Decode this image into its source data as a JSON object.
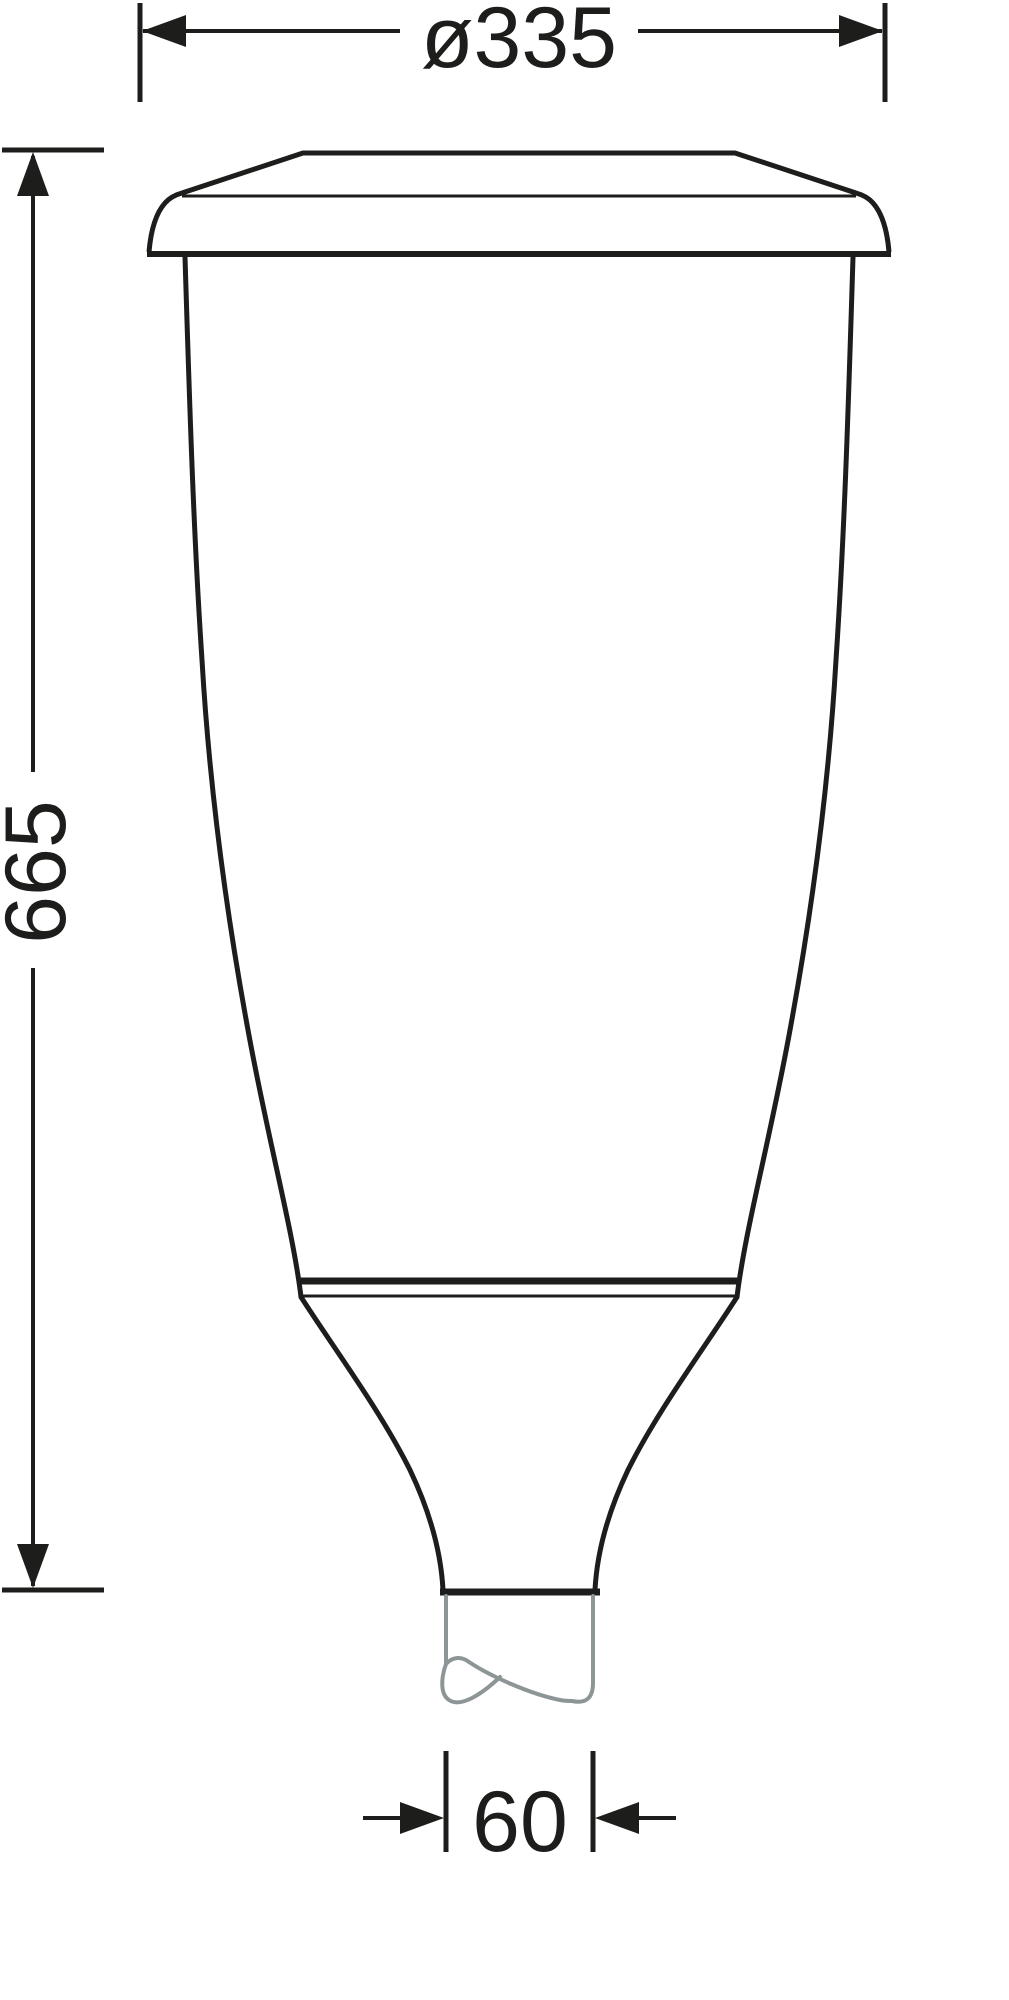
{
  "dimensions": {
    "diameter": {
      "label": "ø335"
    },
    "height": {
      "label": "665"
    },
    "spigot_width": {
      "label": "60"
    }
  },
  "colors": {
    "line": "#1d1d1b",
    "pole": "#8e9597",
    "background": "#ffffff"
  }
}
